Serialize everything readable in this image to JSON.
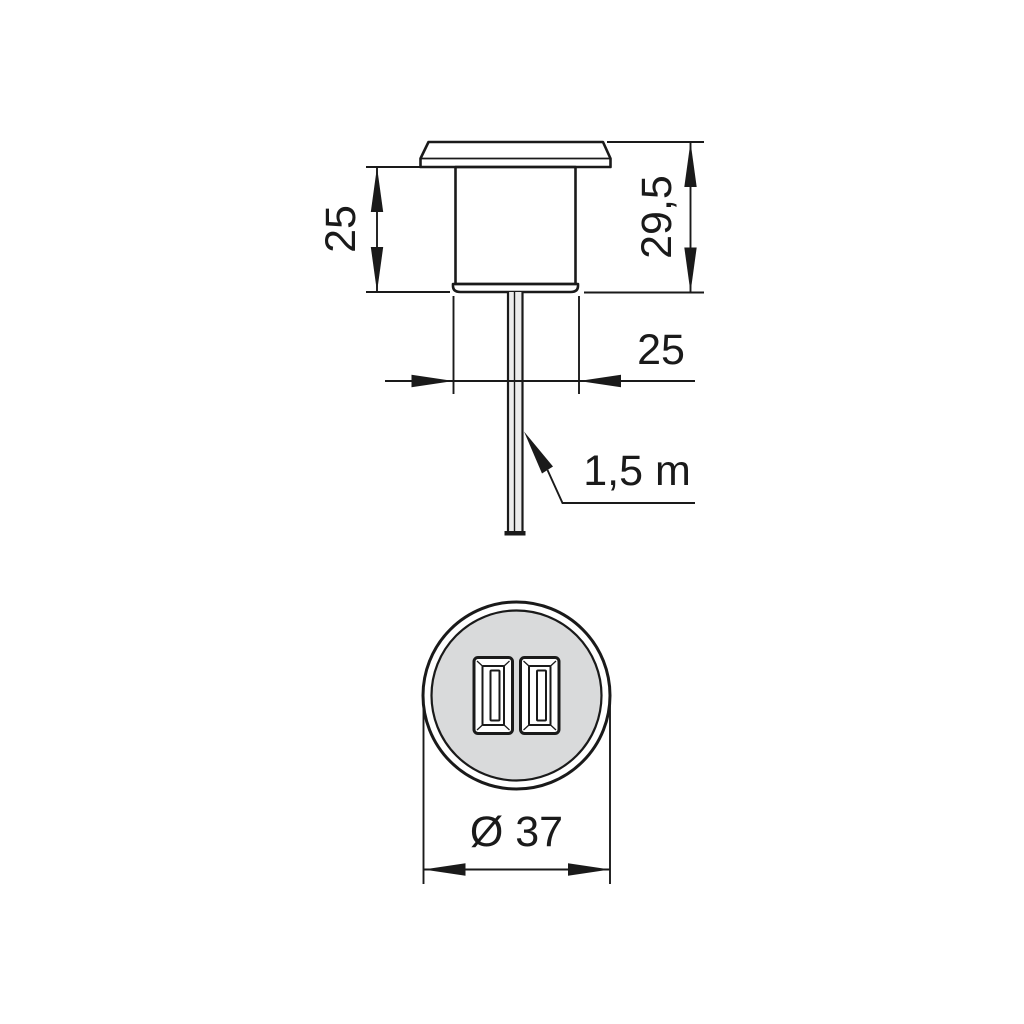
{
  "drawing": {
    "side_view": {
      "height_label": "25",
      "total_height_label": "29,5",
      "width_label": "25",
      "cable_label": "1,5 m"
    },
    "front_view": {
      "diameter_label": "Ø 37"
    },
    "colors": {
      "line": "#1a1a1a",
      "body_fill": "#d9dadb",
      "flange_fill": "#e9eaea",
      "cable_fill": "#ececec",
      "port_face_fill": "#ffffff",
      "background": "#ffffff"
    }
  }
}
